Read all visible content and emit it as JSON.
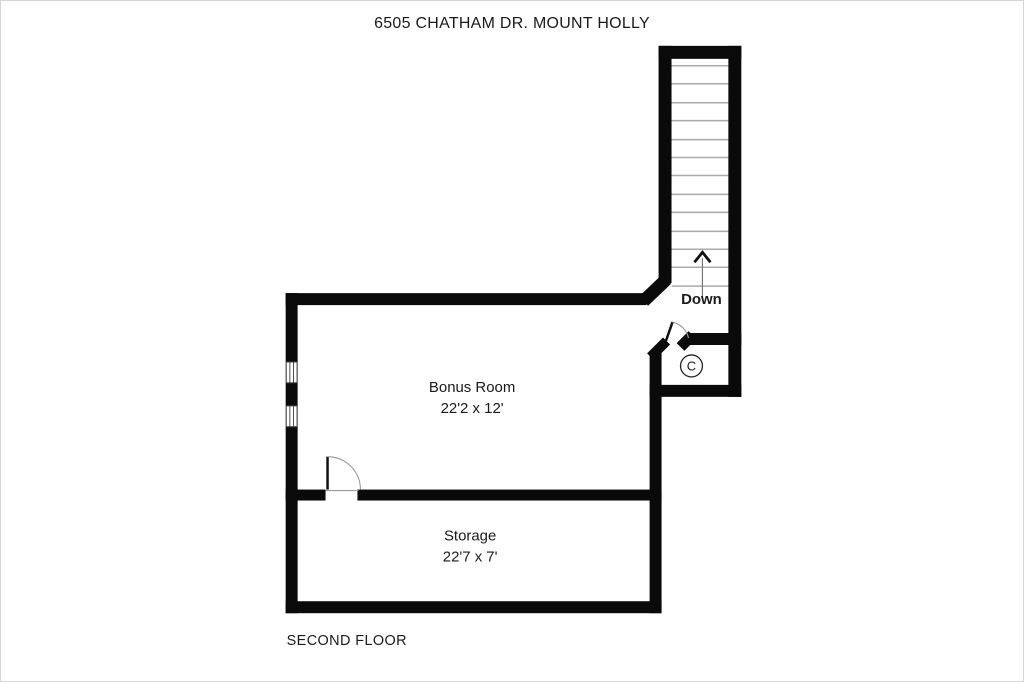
{
  "page": {
    "title": "6505 CHATHAM DR. MOUNT HOLLY",
    "floor_label": "SECOND FLOOR"
  },
  "rooms": {
    "bonus": {
      "name": "Bonus Room",
      "dimensions": "22'2 x 12'",
      "windows": 2
    },
    "storage": {
      "name": "Storage",
      "dimensions": "22'7 x 7'"
    },
    "closet": {
      "label": "C"
    }
  },
  "stairs": {
    "label": "Down",
    "direction_icon": "up-arrow",
    "tread_count": 13
  },
  "colors": {
    "wall": "#0a0a0a",
    "tread": "#aaaaaa",
    "door_arc": "#999999",
    "text": "#1a1a1a",
    "background": "#ffffff",
    "page_border": "#d5d5d5"
  }
}
